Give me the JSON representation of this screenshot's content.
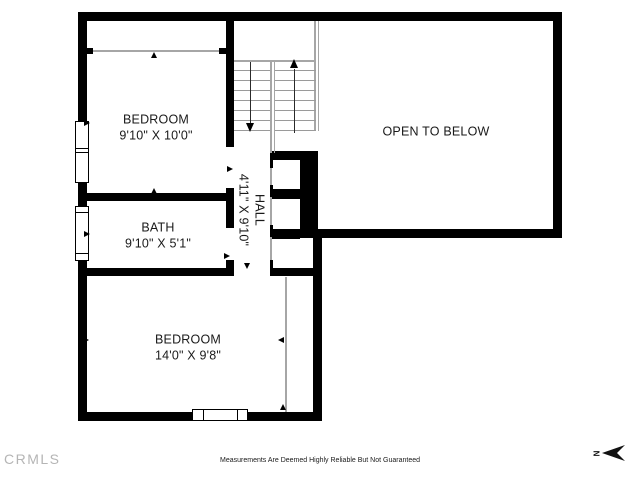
{
  "plan": {
    "rooms": [
      {
        "name": "BEDROOM",
        "dims": "9'10\" X 10'0\""
      },
      {
        "name": "BATH",
        "dims": "9'10\" X 5'1\""
      },
      {
        "name": "HALL",
        "dims": "4'11\" X 9'10\""
      },
      {
        "name": "OPEN TO BELOW",
        "dims": ""
      },
      {
        "name": "BEDROOM",
        "dims": "14'0\" X 9'8\""
      }
    ]
  },
  "footer": {
    "logo": "CRMLS",
    "disclaimer": "Measurements Are Deemed Highly Reliable But Not Guaranteed",
    "north_label": "N"
  }
}
